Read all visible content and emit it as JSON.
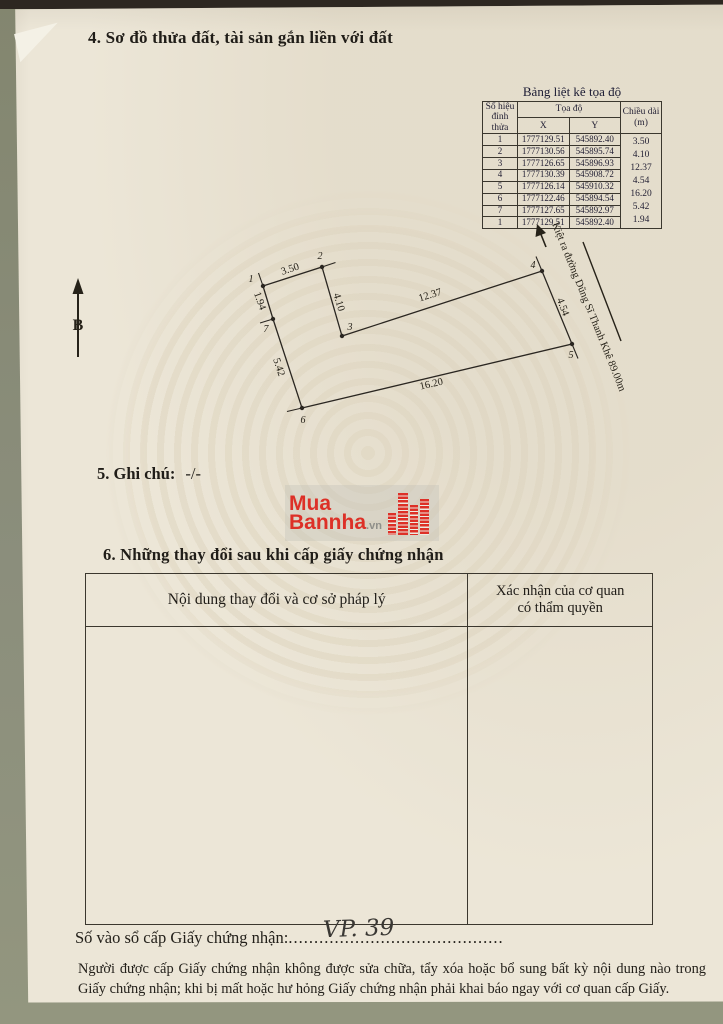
{
  "page": {
    "section4_title": "4. Sơ đồ thửa đất, tài sản gắn liền với đất",
    "section5_label": "5. Ghi chú:",
    "section5_value": "-/-",
    "section6_title": "6. Những thay đổi sau khi cấp giấy chứng nhận",
    "register_label": "Số vào sổ cấp Giấy chứng nhận:",
    "register_dots_left": "...",
    "register_value": "VP. 39",
    "register_dots_right": ".......................................",
    "footer_note": "Người được cấp Giấy chứng nhận không được sửa chữa, tẩy xóa hoặc bổ sung bất kỳ nội dung nào trong Giấy chứng nhận; khi bị mất hoặc hư hỏng Giấy chứng nhận phải khai báo ngay với cơ quan cấp Giấy."
  },
  "coord_table": {
    "title": "Bảng liệt kê tọa độ",
    "header_vertex_line1": "Số hiệu",
    "header_vertex_line2": "đỉnh thửa",
    "header_coord": "Tọa độ",
    "header_x": "X",
    "header_y": "Y",
    "header_length_line1": "Chiều dài",
    "header_length_line2": "(m)",
    "rows": [
      [
        "1",
        "1777129.51",
        "545892.40"
      ],
      [
        "2",
        "1777130.56",
        "545895.74"
      ],
      [
        "3",
        "1777126.65",
        "545896.93"
      ],
      [
        "4",
        "1777130.39",
        "545908.72"
      ],
      [
        "5",
        "1777126.14",
        "545910.32"
      ],
      [
        "6",
        "1777122.46",
        "545894.54"
      ],
      [
        "7",
        "1777127.65",
        "545892.97"
      ],
      [
        "1",
        "1777129.51",
        "545892.40"
      ]
    ],
    "lengths": [
      "3.50",
      "4.10",
      "12.37",
      "4.54",
      "16.20",
      "5.42",
      "1.94"
    ]
  },
  "diagram": {
    "north_label": "B",
    "road_label": "Kiệt ra đường Dũng Sĩ Thanh Khê 89.00m",
    "vertex_labels": [
      "1",
      "2",
      "3",
      "4",
      "5",
      "6",
      "7"
    ],
    "dims": {
      "d12": "3.50",
      "d23": "4.10",
      "d34": "12.37",
      "d45": "4.54",
      "d56": "16.20",
      "d67": "5.42",
      "d71": "1.94"
    }
  },
  "watermark_logo": {
    "line1": "Mua",
    "line2": "Bannha",
    "suffix": ".vn",
    "accent_color": "#dd3027"
  },
  "changes_table": {
    "col1_header": "Nội dung thay đổi và cơ sở pháp lý",
    "col2_header_line1": "Xác nhận của cơ quan",
    "col2_header_line2": "có thẩm quyền"
  }
}
